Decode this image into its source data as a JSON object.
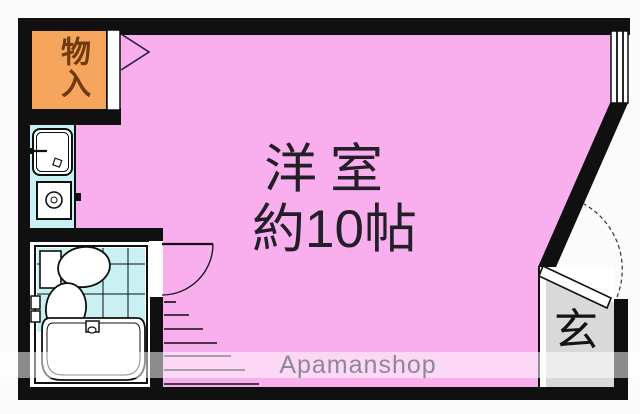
{
  "floorplan": {
    "outside_color": "#FBFBFB",
    "walls_color": "#101010",
    "closet": {
      "label": "物入",
      "fill": "#F5A55C",
      "text_color": "#6E3A0F"
    },
    "room": {
      "label_line1": "洋室",
      "label_line2": "約10帖",
      "fill": "#F9AEED",
      "text_color": "#221F28"
    },
    "kitchen": {
      "fill": "#C9F0F2"
    },
    "bathroom": {
      "fill": "#C9F0F2"
    },
    "entrance": {
      "label": "玄",
      "fill": "#D9D9D9",
      "text_color": "#121212"
    },
    "watermark": {
      "text": "Apamanshop",
      "color": "#8B8A94"
    }
  }
}
